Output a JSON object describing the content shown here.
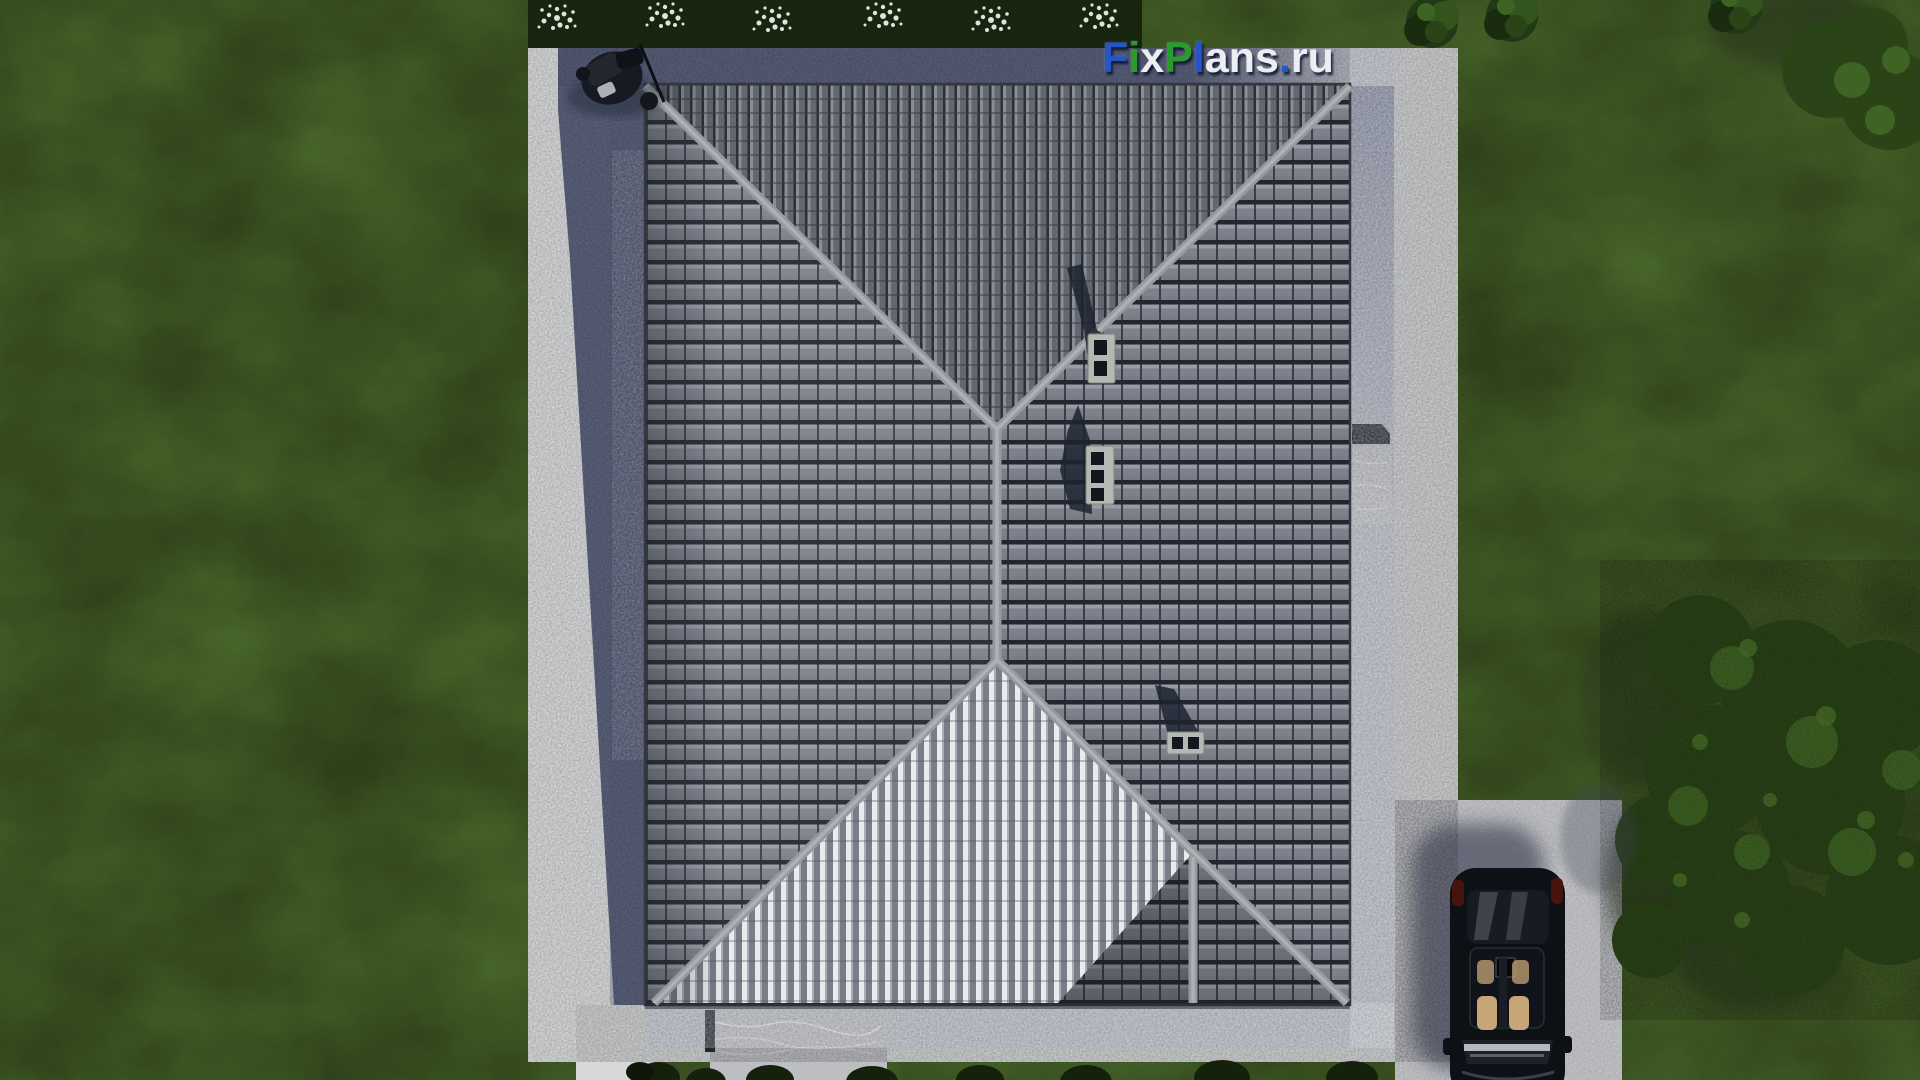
{
  "watermark": {
    "text": "FixPlans.ru",
    "letters": [
      {
        "ch": "F",
        "color": "#2456c8"
      },
      {
        "ch": "i",
        "color": "#2a9b2d"
      },
      {
        "ch": "x",
        "color": "#eceef2"
      },
      {
        "ch": "P",
        "color": "#2a9b2d"
      },
      {
        "ch": "l",
        "color": "#2456c8"
      },
      {
        "ch": "a",
        "color": "#eceef2"
      },
      {
        "ch": "n",
        "color": "#eceef2"
      },
      {
        "ch": "s",
        "color": "#eceef2"
      },
      {
        "ch": ".",
        "color": "#2456c8"
      },
      {
        "ch": "r",
        "color": "#eceef2"
      },
      {
        "ch": "u",
        "color": "#eceef2"
      }
    ]
  },
  "palette": {
    "grass": "#4e6e2d",
    "grass_dark": "#33491c",
    "hedge": "#1b2a11",
    "flower": "#e9efe7",
    "concrete": "#d7d8da",
    "concrete_bright": "#e4e5e7",
    "gravel": "#b9bdc7",
    "driveway": "#cccdd1",
    "marble": "#bcbec2",
    "shadow": "#59607c",
    "shadow_dark": "#1c2330",
    "roof_tile": "#7b7f89",
    "roof_tile_gap": "#23262d",
    "roof_top": "#5b5f67",
    "roof_stripe": "#e9ebee",
    "ridge": "#96999e",
    "ridge_light": "#aeb0b5",
    "chimney_frame": "#b6b8b4",
    "chimney_hole": "#14171d",
    "car_body": "#0d1015",
    "car_seat": "#c6a678",
    "foliage": "#2a4418",
    "foliage_light": "#4c7329"
  }
}
